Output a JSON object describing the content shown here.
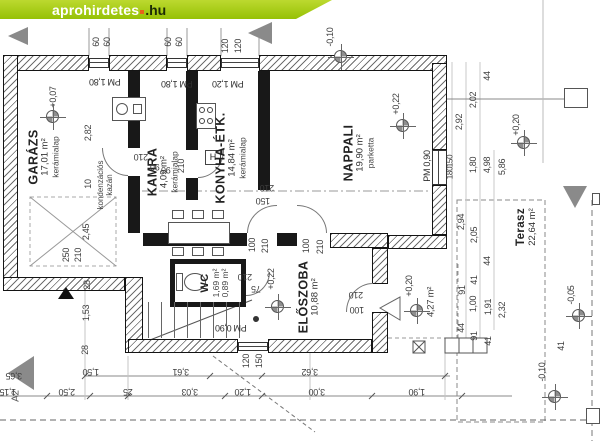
{
  "watermark": {
    "brand": "aprohirdetes",
    "tld": ".hu"
  },
  "markers": {
    "top": "A3",
    "left": "A2"
  },
  "rooms": {
    "garazs": {
      "name": "GARÁZS",
      "area": "17,01 m²",
      "floor": "kerámialap"
    },
    "kamra": {
      "name": "KAMRA",
      "area": "4,09 m²",
      "floor": "kerámialap"
    },
    "konyha": {
      "name": "KONYHA-ÉTK.",
      "area": "14,84 m²",
      "floor": "kerámialap"
    },
    "nappali": {
      "name": "NAPPALI",
      "area": "19,90 m²",
      "floor": "parketta"
    },
    "wc": {
      "name": "WC",
      "area": "1,69 m²",
      "area2": "0,89 m²"
    },
    "eloszoba": {
      "name": "ELŐSZOBA",
      "area": "10,88 m²"
    },
    "terasz": {
      "name": "Terasz",
      "area": "22,64 m²"
    },
    "porch": {
      "area": "4,27 m²"
    }
  },
  "notes": {
    "boiler1": "kondenzációs",
    "boiler2": "kazán",
    "fridge": "H"
  },
  "elevations": {
    "garage": "+0,07",
    "top": "-0,10",
    "nappali": "+0,22",
    "right_top": "+0,20",
    "hall": "+0,22",
    "entry": "+0,20",
    "terrace": "-0,05",
    "bottom": "-0,10"
  },
  "pm": {
    "a": "PM 1,80",
    "b": "PM 1,80",
    "c": "PM 1,20",
    "d": "PM 0,90",
    "e": "PM 0,90"
  },
  "dims_top": [
    "60",
    "60",
    "60",
    "60",
    "120",
    "120"
  ],
  "dims_left": [
    "2,82",
    "10",
    "2,45",
    "250",
    "210",
    "28",
    "1,53",
    "28"
  ],
  "dims_right_c1": [
    "2,92",
    "150",
    "180",
    "2,94",
    "91",
    "44"
  ],
  "dims_right_c2": [
    "2,02",
    "1,80",
    "2,05",
    "41",
    "1,00",
    "91"
  ],
  "dims_right_c3": [
    "44",
    "4,98",
    "44",
    "1,91",
    "41"
  ],
  "dims_right_c4": [
    "5,86",
    "2,32"
  ],
  "dims_bottom_a": [
    "3,65",
    "1,50",
    "3,61",
    "3,62"
  ],
  "dims_bottom_b": [
    "1,15",
    "2,50",
    "25",
    "3,03",
    "1,20",
    "3,00",
    "1,90"
  ],
  "dims_doors": {
    "k1a": "210",
    "k1b": "90",
    "k2a": "90",
    "k2b": "210",
    "n1": "210",
    "n2": "150",
    "e1a": "100",
    "e1b": "210",
    "e2a": "100",
    "e2b": "210",
    "wc1": "210",
    "wc2": "75",
    "en1": "210",
    "en2": "100",
    "bw1": "120",
    "bw2": "150",
    "pr": "41"
  }
}
